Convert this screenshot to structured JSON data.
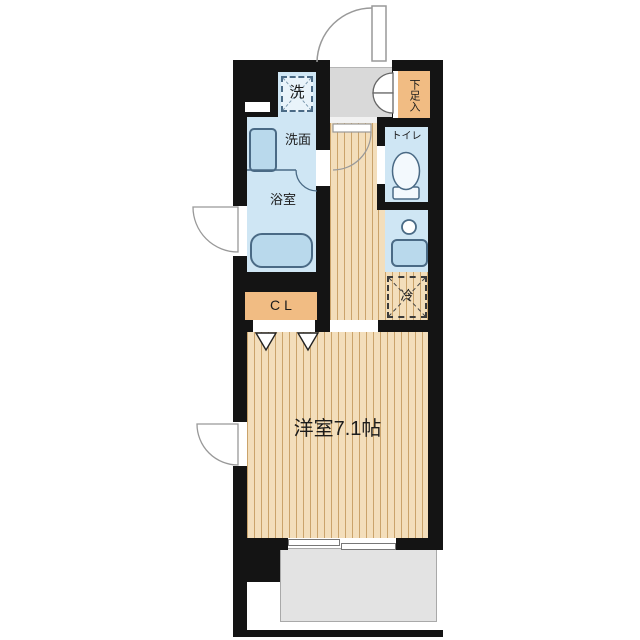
{
  "floorplan": {
    "labels": {
      "washer": "洗",
      "washbasin_room": "洗面",
      "bathroom": "浴室",
      "toilet": "トイレ",
      "shoe_cabinet": "下足入",
      "refrigerator": "冷",
      "closet": "CL",
      "western_room": "洋室7.1帖"
    },
    "colors": {
      "wall": "#141414",
      "wet_area_blue": "#cfe6f4",
      "fixture_blue": "#b9d9ec",
      "fixture_outline": "#4a6a85",
      "wood_floor": "#f3debb",
      "wood_stripe": "#caa36b",
      "closet_orange": "#f1bc83",
      "entry_gray": "#d9d9d9",
      "balcony_gray": "#e3e3e3"
    }
  }
}
